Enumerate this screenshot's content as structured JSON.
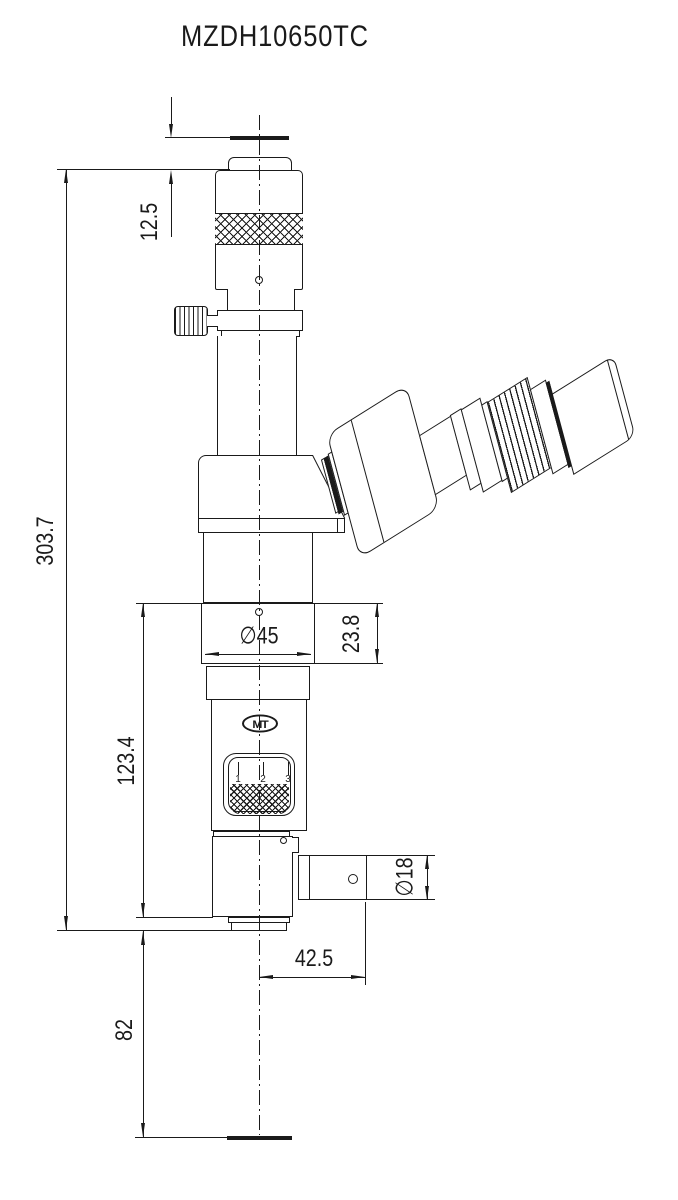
{
  "sheet": {
    "title": "MZDH10650TC"
  },
  "logo": {
    "text": "MT"
  },
  "zoom_indicator": {
    "ticks": [
      "1",
      "2",
      "3"
    ]
  },
  "dimensions": {
    "cap_height": {
      "value": "12.5"
    },
    "overall_height": {
      "value": "303.7"
    },
    "lower_height": {
      "value": "123.4"
    },
    "working_distance": {
      "value": "82"
    },
    "body_diameter": {
      "value": "∅45"
    },
    "flange_height": {
      "value": "23.8"
    },
    "arm_bore_diameter": {
      "value": "∅18"
    },
    "arm_offset": {
      "value": "42.5"
    }
  },
  "colors": {
    "line": "#1a1a1a",
    "background": "#ffffff"
  }
}
